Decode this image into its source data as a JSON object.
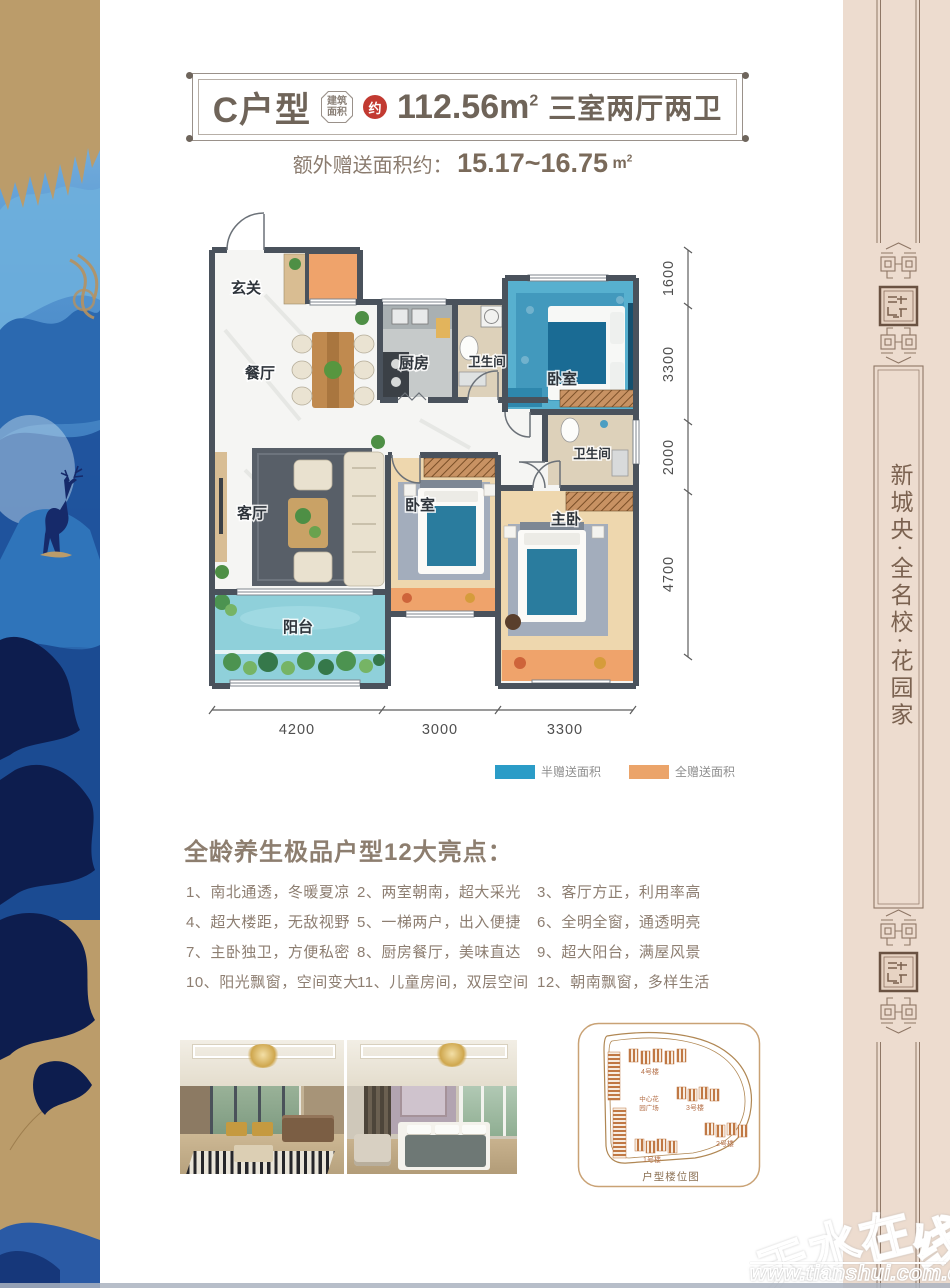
{
  "header": {
    "unit": "C户型",
    "area_type_line1": "建筑",
    "area_type_line2": "面积",
    "approx": "约",
    "area_value": "112.56m",
    "area_sup": "2",
    "layout_desc": "三室两厅两卫",
    "bonus_label": "额外赠送面积约：",
    "bonus_value": "15.17~16.75",
    "bonus_unit": "m",
    "bonus_sup": "2"
  },
  "floorplan": {
    "rooms": [
      "玄关",
      "餐厅",
      "厨房",
      "卫生间",
      "卧室",
      "卫生间",
      "客厅",
      "卧室",
      "主卧",
      "阳台"
    ],
    "dims_right": [
      "1600",
      "3300",
      "2000",
      "4700"
    ],
    "dims_bottom": [
      "4200",
      "3000",
      "3300"
    ],
    "legend": [
      {
        "label": "半赠送面积",
        "color": "#2b9cc7"
      },
      {
        "label": "全赠送面积",
        "color": "#eba46a"
      }
    ]
  },
  "highlights": {
    "title": "全龄养生极品户型12大亮点：",
    "items": [
      {
        "num": "1、",
        "text": "南北通透，冬暖夏凉"
      },
      {
        "num": "2、",
        "text": "两室朝南，超大采光"
      },
      {
        "num": "3、",
        "text": "客厅方正，利用率高"
      },
      {
        "num": "4、",
        "text": "超大楼距，无敌视野"
      },
      {
        "num": "5、",
        "text": "一梯两户，出入便捷"
      },
      {
        "num": "6、",
        "text": "全明全窗，通透明亮"
      },
      {
        "num": "7、",
        "text": "主卧独卫，方便私密"
      },
      {
        "num": "8、",
        "text": "厨房餐厅，美味直达"
      },
      {
        "num": "9、",
        "text": "超大阳台，满屋风景"
      },
      {
        "num": "10、",
        "text": "阳光飘窗，空间变大"
      },
      {
        "num": "11、",
        "text": "儿童房间，双层空间"
      },
      {
        "num": "12、",
        "text": "朝南飘窗，多样生活"
      }
    ]
  },
  "siteplan": {
    "caption": "户型楼位图",
    "plaza_line1": "中心花",
    "plaza_line2": "园广场",
    "buildings": [
      "4号楼",
      "3号楼",
      "2号楼",
      "1号楼"
    ]
  },
  "sidebar": {
    "slogan": "新城央·全名校·花园家"
  },
  "watermark": {
    "chars": [
      "天",
      "水",
      "在",
      "线"
    ],
    "url": "www.tianshui.com.cn"
  }
}
